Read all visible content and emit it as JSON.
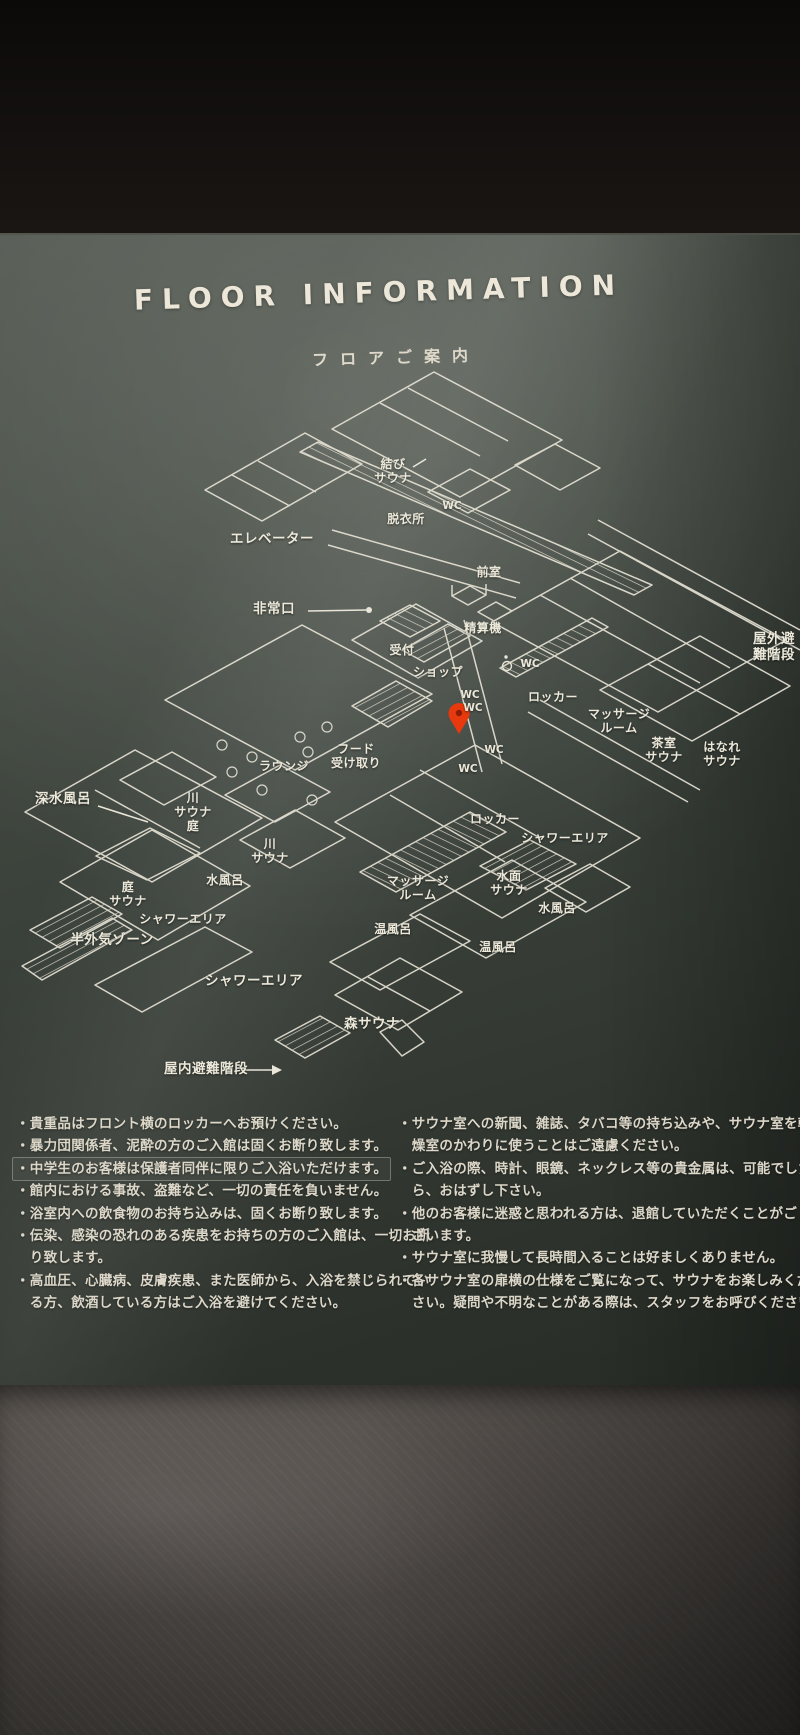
{
  "header": {
    "title": "FLOOR INFORMATION",
    "subtitle": "フロアご案内"
  },
  "map": {
    "line_color": "#e9e5d8",
    "pin_color": "#e8380d",
    "labels": [
      {
        "text": "結び\nサウナ"
      },
      {
        "text": "WC"
      },
      {
        "text": "脱衣所"
      },
      {
        "text": "エレベーター"
      },
      {
        "text": "前室"
      },
      {
        "text": "非常口"
      },
      {
        "text": "精算機"
      },
      {
        "text": "受付"
      },
      {
        "text": "ショップ"
      },
      {
        "text": "WC"
      },
      {
        "text": "WC"
      },
      {
        "text": "WC"
      },
      {
        "text": "WC"
      },
      {
        "text": "WC"
      },
      {
        "text": "ロッカー"
      },
      {
        "text": "マッサージ\nルーム"
      },
      {
        "text": "茶室\nサウナ"
      },
      {
        "text": "はなれ\nサウナ"
      },
      {
        "text": "屋外避難階段"
      },
      {
        "text": "ラウンジ"
      },
      {
        "text": "フード\n受け取り"
      },
      {
        "text": "深水風呂"
      },
      {
        "text": "川\nサウナ\n庭"
      },
      {
        "text": "川\nサウナ"
      },
      {
        "text": "水風呂"
      },
      {
        "text": "庭\nサウナ"
      },
      {
        "text": "シャワーエリア"
      },
      {
        "text": "半外気ゾーン"
      },
      {
        "text": "ロッカー"
      },
      {
        "text": "シャワーエリア"
      },
      {
        "text": "マッサージ\nルーム"
      },
      {
        "text": "水面\nサウナ"
      },
      {
        "text": "水風呂"
      },
      {
        "text": "温風呂"
      },
      {
        "text": "温風呂"
      },
      {
        "text": "シャワーエリア"
      },
      {
        "text": "森サウナ"
      },
      {
        "text": "屋内避難階段"
      }
    ]
  },
  "notes": {
    "left": [
      "・貴重品はフロント横のロッカーへお預けください。",
      "・暴力団関係者、泥酔の方のご入館は固くお断り致します。",
      "・中学生のお客様は保護者同伴に限りご入浴いただけます。",
      "・館内における事故、盗難など、一切の責任を負いません。",
      "・浴室内への飲食物のお持ち込みは、固くお断り致します。",
      "・伝染、感染の恐れのある疾患をお持ちの方のご入館は、一切お断",
      "　り致します。",
      "・高血圧、心臓病、皮膚疾患、また医師から、入浴を禁じられてい",
      "　る方、飲酒している方はご入浴を避けてください。"
    ],
    "right": [
      "・サウナ室への新聞、雑誌、タバコ等の持ち込みや、サウナ室を乾",
      "　燥室のかわりに使うことはご遠慮ください。",
      "・ご入浴の際、時計、眼鏡、ネックレス等の貴金属は、可能でした",
      "　ら、おはずし下さい。",
      "・他のお客様に迷惑と思われる方は、退館していただくことがご",
      "　ざいます。",
      "・サウナ室に我慢して長時間入ることは好ましくありません。",
      "・各サウナ室の扉横の仕様をご覧になって、サウナをお楽しみくだ",
      "　さい。疑問や不明なことがある際は、スタッフをお呼びください。"
    ]
  }
}
